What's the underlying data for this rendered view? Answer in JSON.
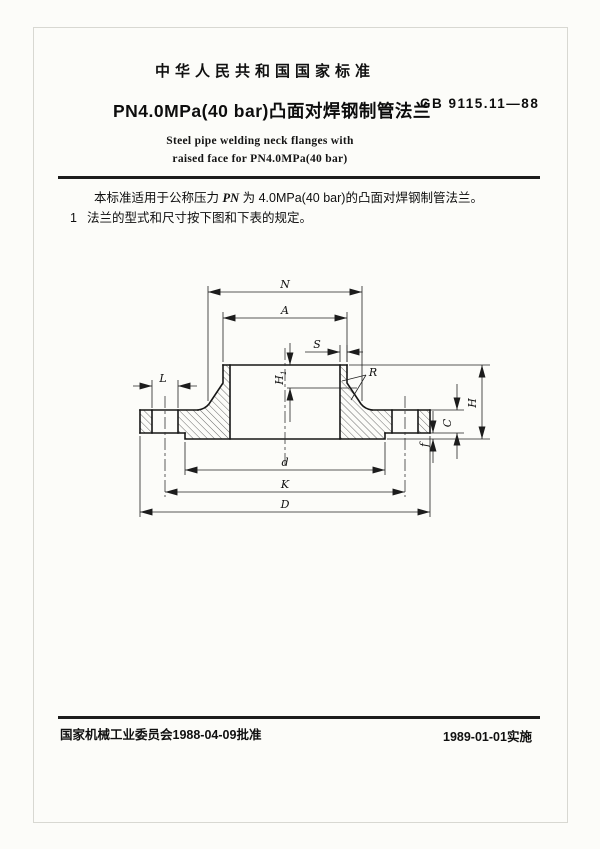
{
  "header": {
    "national_standard": "中华人民共和国国家标准",
    "title_cn": "PN4.0MPa(40 bar)凸面对焊钢制管法兰",
    "std_no": "GB 9115.11—88",
    "title_en_line1": "Steel pipe welding neck flanges with",
    "title_en_line2": "raised face for PN4.0MPa(40 bar)"
  },
  "body": {
    "scope_part1": "本标准适用于公称压力 ",
    "scope_pn": "PN",
    "scope_part2": " 为 4.0MPa(40 bar)的凸面对焊钢制管法兰。",
    "clause_no": "1",
    "clause_text": "法兰的型式和尺寸按下图和下表的规定。"
  },
  "drawing": {
    "type": "flange-cross-section",
    "labels": {
      "N": "N",
      "A": "A",
      "S": "S",
      "R": "R",
      "L": "L",
      "H1_main": "H",
      "H1_sub": "1",
      "f": "f",
      "C": "C",
      "H": "H",
      "d": "d",
      "K": "K",
      "D": "D"
    }
  },
  "footer": {
    "approved": "国家机械工业委员会1988-04-09批准",
    "implemented": "1989-01-01实施"
  }
}
